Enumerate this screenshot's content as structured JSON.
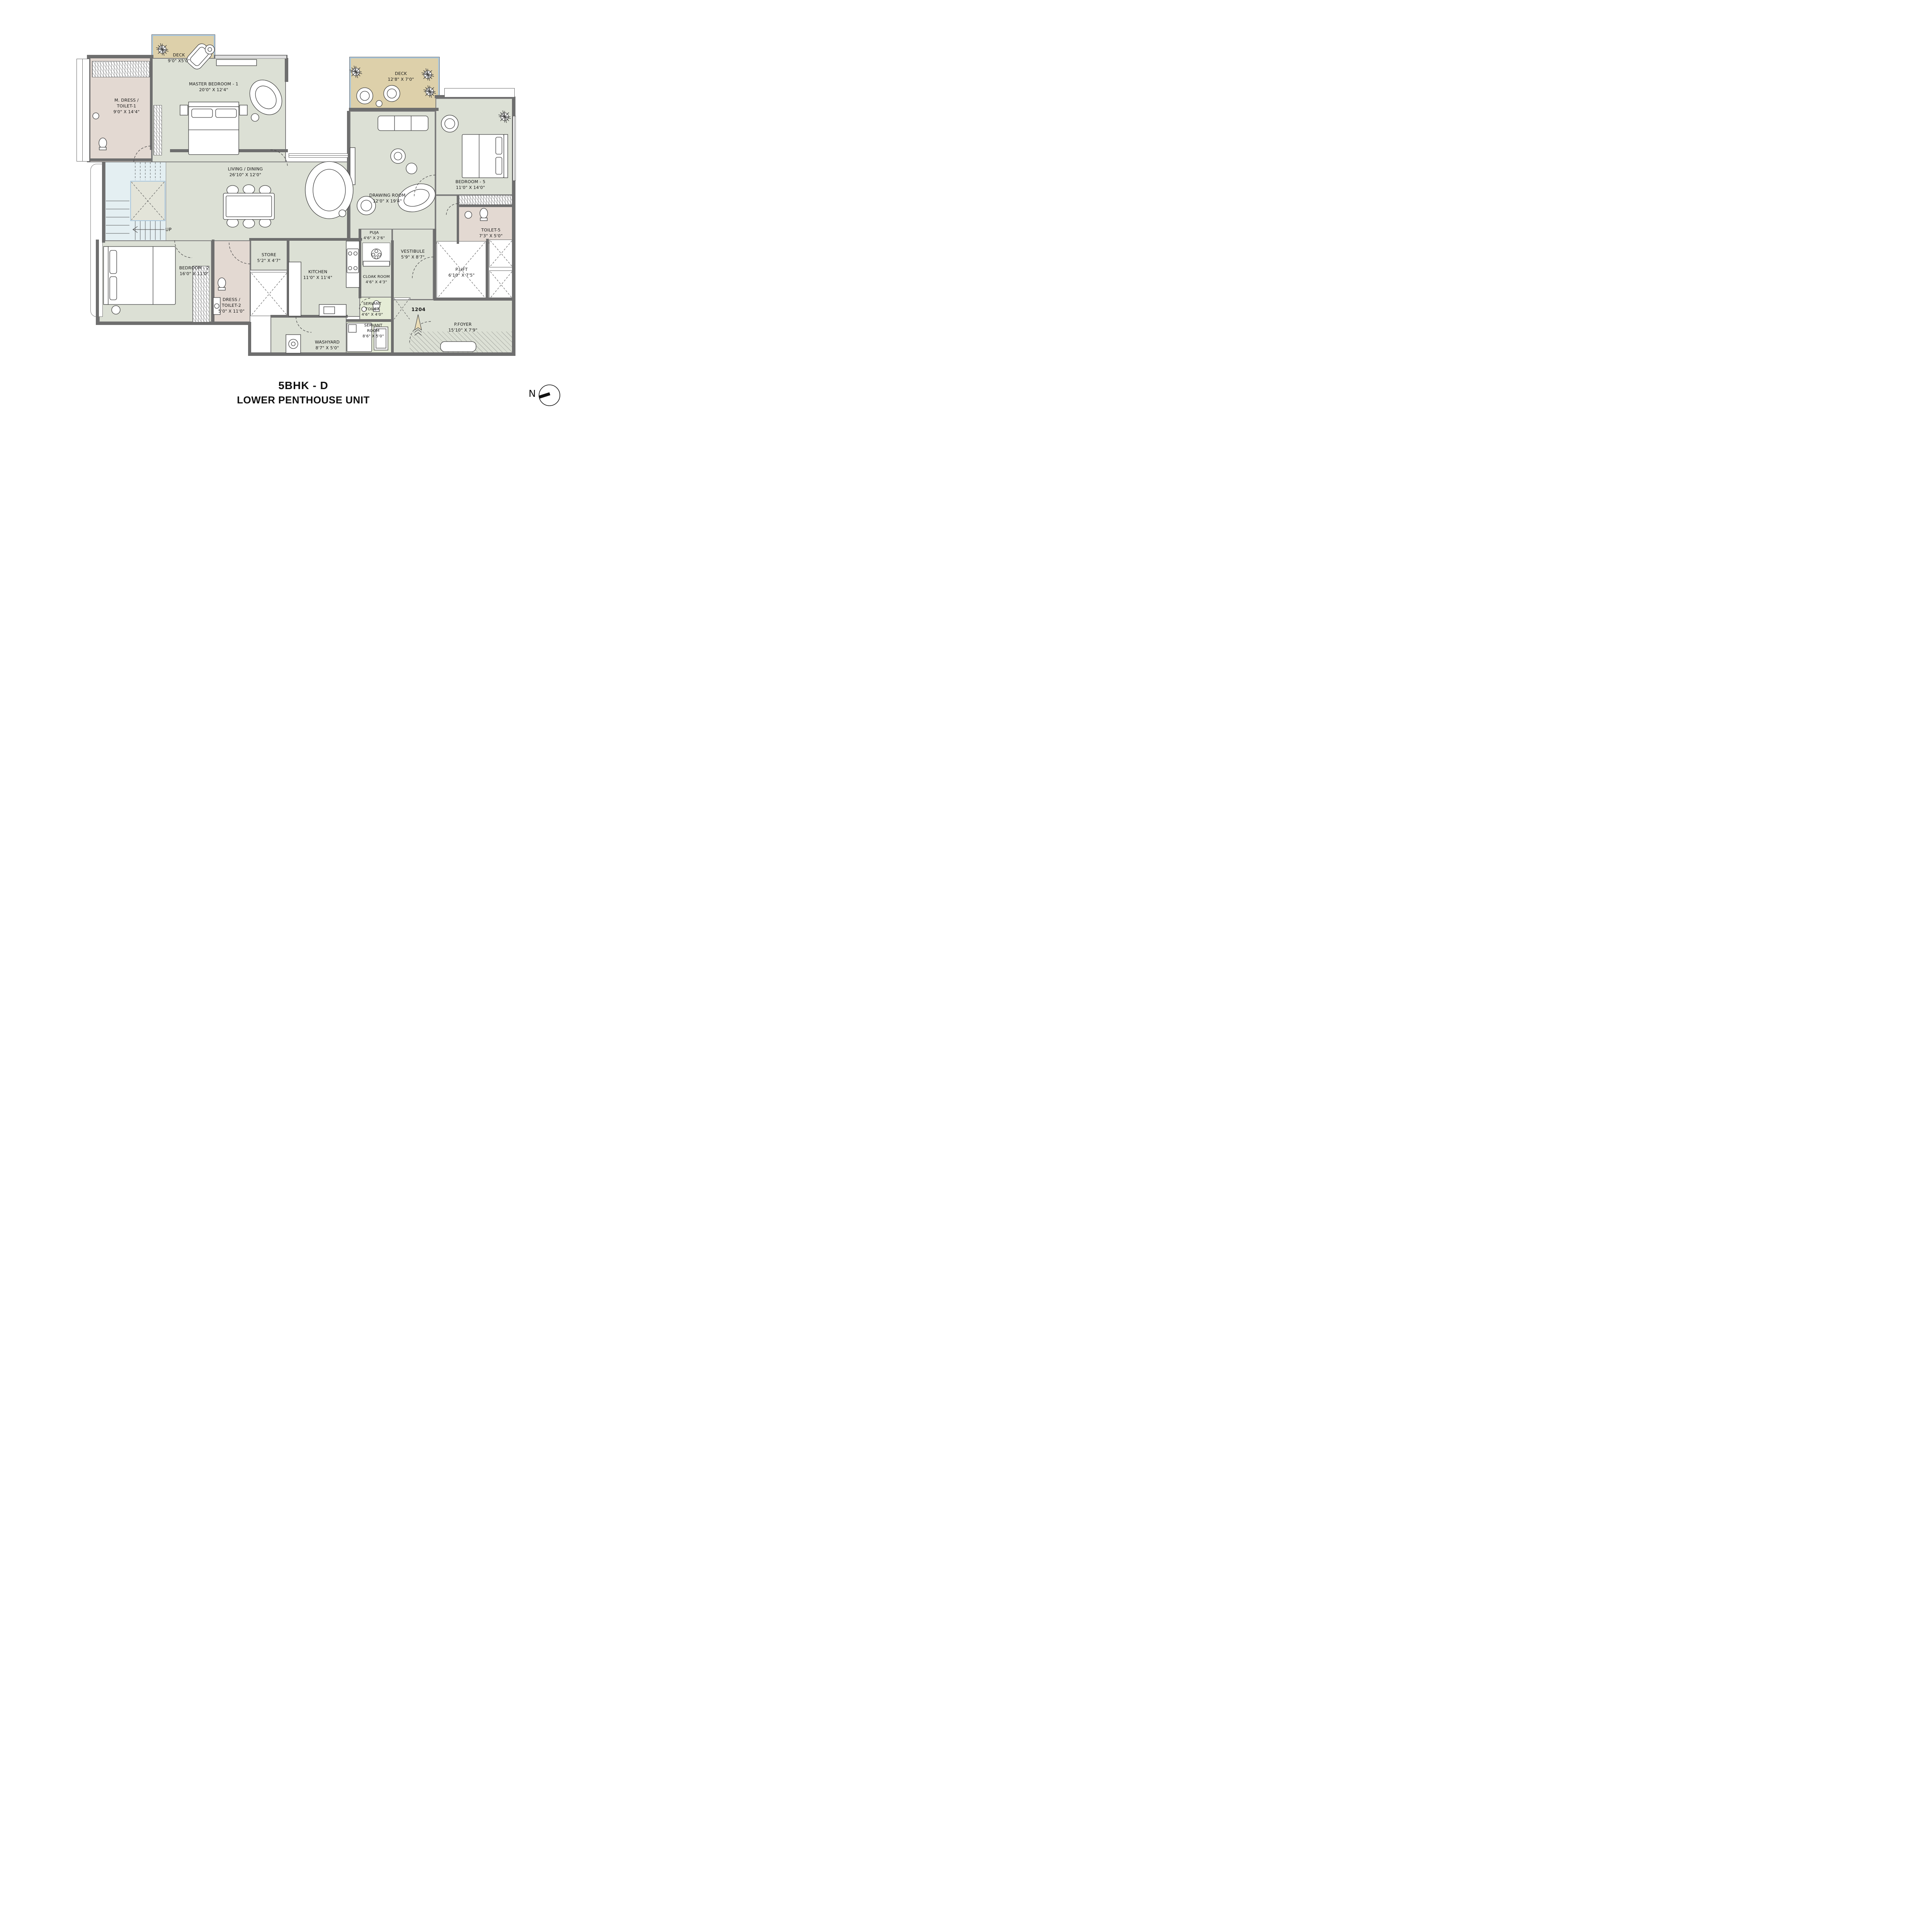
{
  "title": {
    "line1": "5BHK - D",
    "line2": "LOWER PENTHOUSE UNIT"
  },
  "unit_number": "1204",
  "compass": {
    "label": "N"
  },
  "stairs": {
    "up_label": "UP"
  },
  "colors": {
    "room_fill": "#dce0d5",
    "toilet_fill": "#e3d9d2",
    "deck_fill": "#ddd0aa",
    "deck_frame": "#a9c6dc",
    "servant_fill": "#e5ecd6",
    "stairs_fill": "#e4eff2",
    "wall": "#6e6e6e"
  },
  "rooms": [
    {
      "id": "deck-1",
      "name": "DECK",
      "dims": "9'0\" X5'0\""
    },
    {
      "id": "master-bedroom",
      "name": "MASTER BEDROOM - 1",
      "dims": "20'0\" X 12'4\""
    },
    {
      "id": "m-dress-toilet",
      "name": "M. DRESS /",
      "name2": "TOILET-1",
      "dims": "9'0\" X 14'4\""
    },
    {
      "id": "deck-2",
      "name": "DECK",
      "dims": "12'8\" X 7'0\""
    },
    {
      "id": "living-dining",
      "name": "LIVING /  DINING",
      "dims": "26'10\" X 12'0\""
    },
    {
      "id": "drawing-room",
      "name": "DRAWING ROOM",
      "dims": "12'0\" X 19'4\""
    },
    {
      "id": "bedroom-5",
      "name": "BEDROOM - 5",
      "dims": "11'0\" X 14'0\""
    },
    {
      "id": "toilet-5",
      "name": "TOILET-5",
      "dims": "7'3\" X 5'0\""
    },
    {
      "id": "p-lift",
      "name": "P.LIFT",
      "dims": "6'10\" X 7'5\""
    },
    {
      "id": "puja",
      "name": "PUJA",
      "dims": "4'6\" X 2'6\""
    },
    {
      "id": "vestibule",
      "name": "VESTIBULE",
      "dims": "5'9\" X 8'7\""
    },
    {
      "id": "kitchen",
      "name": "KITCHEN",
      "dims": "11'0\" X 11'4\""
    },
    {
      "id": "cloak-room",
      "name": "CLOAK ROOM",
      "dims": "4'6\" X 4'3\""
    },
    {
      "id": "store",
      "name": "STORE",
      "dims": "5'2\" X 4'7\""
    },
    {
      "id": "bedroom-2",
      "name": "BEDROOM - 2",
      "dims": "16'0\" X 11'0\""
    },
    {
      "id": "dress-toilet-2",
      "name": "DRESS /",
      "name2": "TOILET-2",
      "dims": "5'0\" X 11'0\""
    },
    {
      "id": "servant-toilet",
      "name": "SERVANT",
      "name2": "TOILET",
      "dims": "4'6\" X 4'0\""
    },
    {
      "id": "servant-room",
      "name": "SERVANT",
      "name2": "ROOM",
      "dims": "8'6\" X 5'0\""
    },
    {
      "id": "washyard",
      "name": "WASHYARD",
      "dims": "8'7\" X 5'0\""
    },
    {
      "id": "p-foyer",
      "name": "P.FOYER",
      "dims": "15'10\" X 7'9\""
    }
  ]
}
